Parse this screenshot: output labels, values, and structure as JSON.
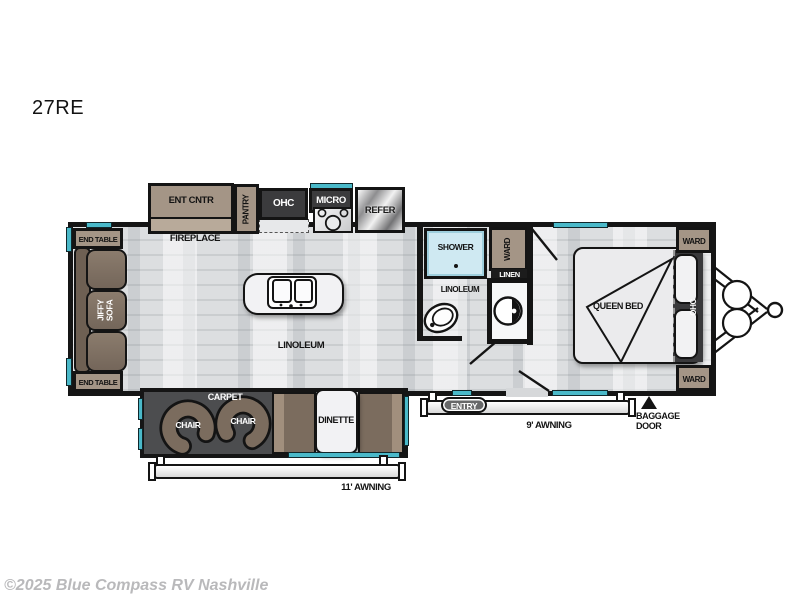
{
  "title": "27RE",
  "watermark": "©2025 Blue Compass RV Nashville",
  "colors": {
    "accent_teal": "#4ab9c9",
    "wall_black": "#151515",
    "floor_gray": "#d6d8da",
    "carpet_gray": "#4c4d4f",
    "cabinet_tan": "#a49586",
    "upholstery_brown": "#7b6c5e",
    "cabinet_dark": "#3b3b3d",
    "shower_blue": "#cfe9f2"
  },
  "rooms": {
    "kitchen": {
      "ent_cntr": "ENT CNTR",
      "fireplace": "FIREPLACE",
      "pantry": "PANTRY",
      "ohc": "OHC",
      "micro": "MICRO",
      "refer": "REFER",
      "floor": "LINOLEUM"
    },
    "living": {
      "end_table_top": "END TABLE",
      "end_table_bottom": "END TABLE",
      "sofa": "JIFFY SOFA",
      "carpet": "CARPET",
      "chair_left": "CHAIR",
      "chair_right": "CHAIR",
      "dinette": "DINETTE"
    },
    "bath": {
      "shower": "SHOWER",
      "ward": "WARD",
      "linen": "LINEN",
      "floor": "LINOLEUM"
    },
    "bedroom": {
      "bed": "QUEEN BED",
      "ohc": "OHC",
      "ward_front": "WARD",
      "ward_rear": "WARD"
    },
    "exterior": {
      "entry": "ENTRY",
      "awning_door_side": "9' AWNING",
      "awning_camp_side": "11' AWNING",
      "baggage_line1": "BAGGAGE",
      "baggage_line2": "DOOR"
    }
  }
}
